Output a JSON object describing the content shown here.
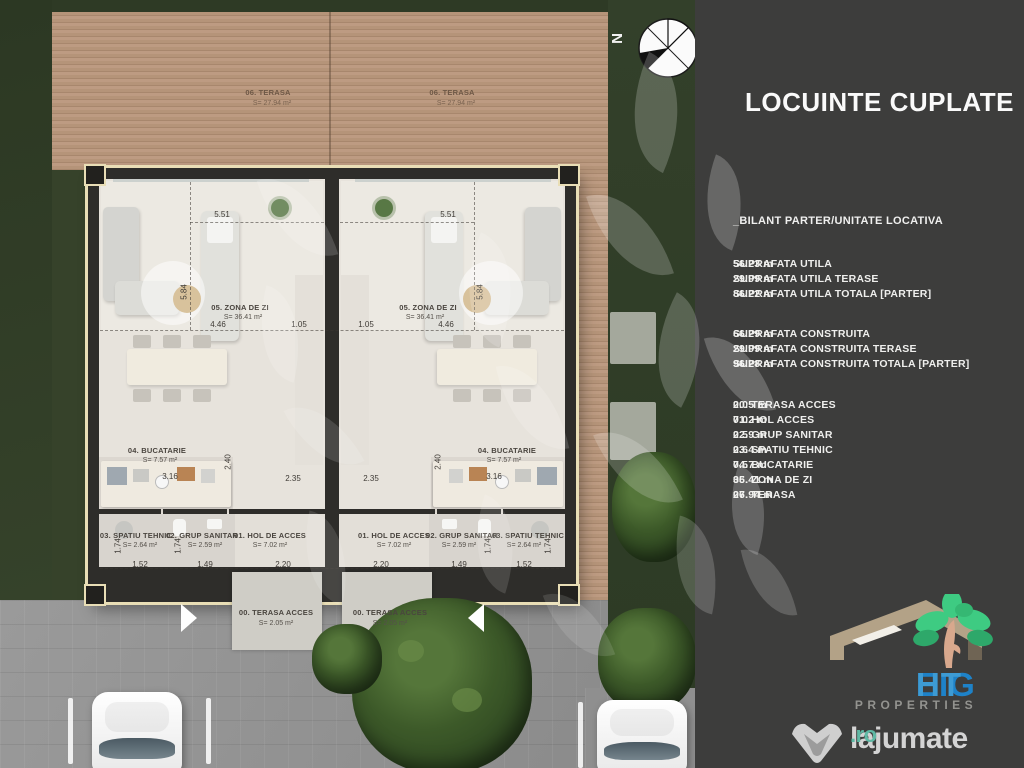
{
  "sidebar": {
    "title": "LOCUINTE CUPLATE",
    "section_title": "_BILANT PARTER/UNITATE LOCATIVA",
    "utila": [
      {
        "label": "SUPRAFATA UTILA",
        "value": "56.23 m"
      },
      {
        "label": "SUPRAFATA UTILA TERASE",
        "value": "29.99 m"
      },
      {
        "label": "SUPRAFATA UTILA TOTALA [PARTER]",
        "value": "86.22 m"
      }
    ],
    "construita": [
      {
        "label": "SUPRAFATA CONSTRUITA",
        "value": "66.29 m"
      },
      {
        "label": "SUPRAFATA CONSTRUITA TERASE",
        "value": "29.99 m"
      },
      {
        "label": "SUPRAFATA CONSTRUITA TOTALA [PARTER]",
        "value": "96.28 m"
      }
    ],
    "rooms": [
      {
        "label": "00. TERASA ACCES",
        "value": "2.05 m"
      },
      {
        "label": "01. HOL ACCES",
        "value": "7.02 m"
      },
      {
        "label": "02. GRUP SANITAR",
        "value": "2.59 m"
      },
      {
        "label": "03. SPATIU TEHNIC",
        "value": "2.64 m"
      },
      {
        "label": "04. BUCATARIE",
        "value": "7.57 m"
      },
      {
        "label": "05. ZONA DE ZI",
        "value": "36.41 m"
      },
      {
        "label": "06. TERASA",
        "value": "27.94 m"
      }
    ],
    "eight_logo": {
      "name_a": "EIG",
      "name_b": "HT",
      "subtitle": "PROPERTIES"
    },
    "lajumate": {
      "brand": "lajumate",
      "tld": ".ro"
    }
  },
  "plan": {
    "north_label": "N",
    "rooms": {
      "terasa": {
        "title": "06. TERASA",
        "area": "S= 27.94 m²"
      },
      "zona": {
        "title": "05. ZONA DE ZI",
        "area": "S= 36.41 m²"
      },
      "bucatarie": {
        "title": "04. BUCATARIE",
        "area": "S= 7.57 m²"
      },
      "spatiu_tehnic": {
        "title": "03. SPATIU TEHNIC",
        "area": "S= 2.64 m²"
      },
      "grup_sanitar": {
        "title": "02. GRUP SANITAR",
        "area": "S= 2.59 m²"
      },
      "hol": {
        "title": "01. HOL DE ACCES",
        "area": "S= 7.02 m²"
      },
      "terasa_acces": {
        "title": "00. TERASA ACCES",
        "area": "S= 2.05 m²"
      }
    },
    "dims": {
      "living_w_top": "5.51",
      "living_h": "5.84",
      "living_w": "4.46",
      "side": "1.05",
      "kitchen_w": "3.16",
      "mid": "2.35",
      "kitchen_h": "2.40",
      "tehnic_w": "1.52",
      "sanitar_w": "1.49",
      "hol_w": "2.20",
      "room_h": "1.74"
    }
  },
  "colors": {
    "sidebar_bg": "#3d3d3c",
    "eight_blue": "#1e82c8",
    "eight_green": "#3ecb82",
    "lajumate_teal": "#5fb9a5"
  }
}
